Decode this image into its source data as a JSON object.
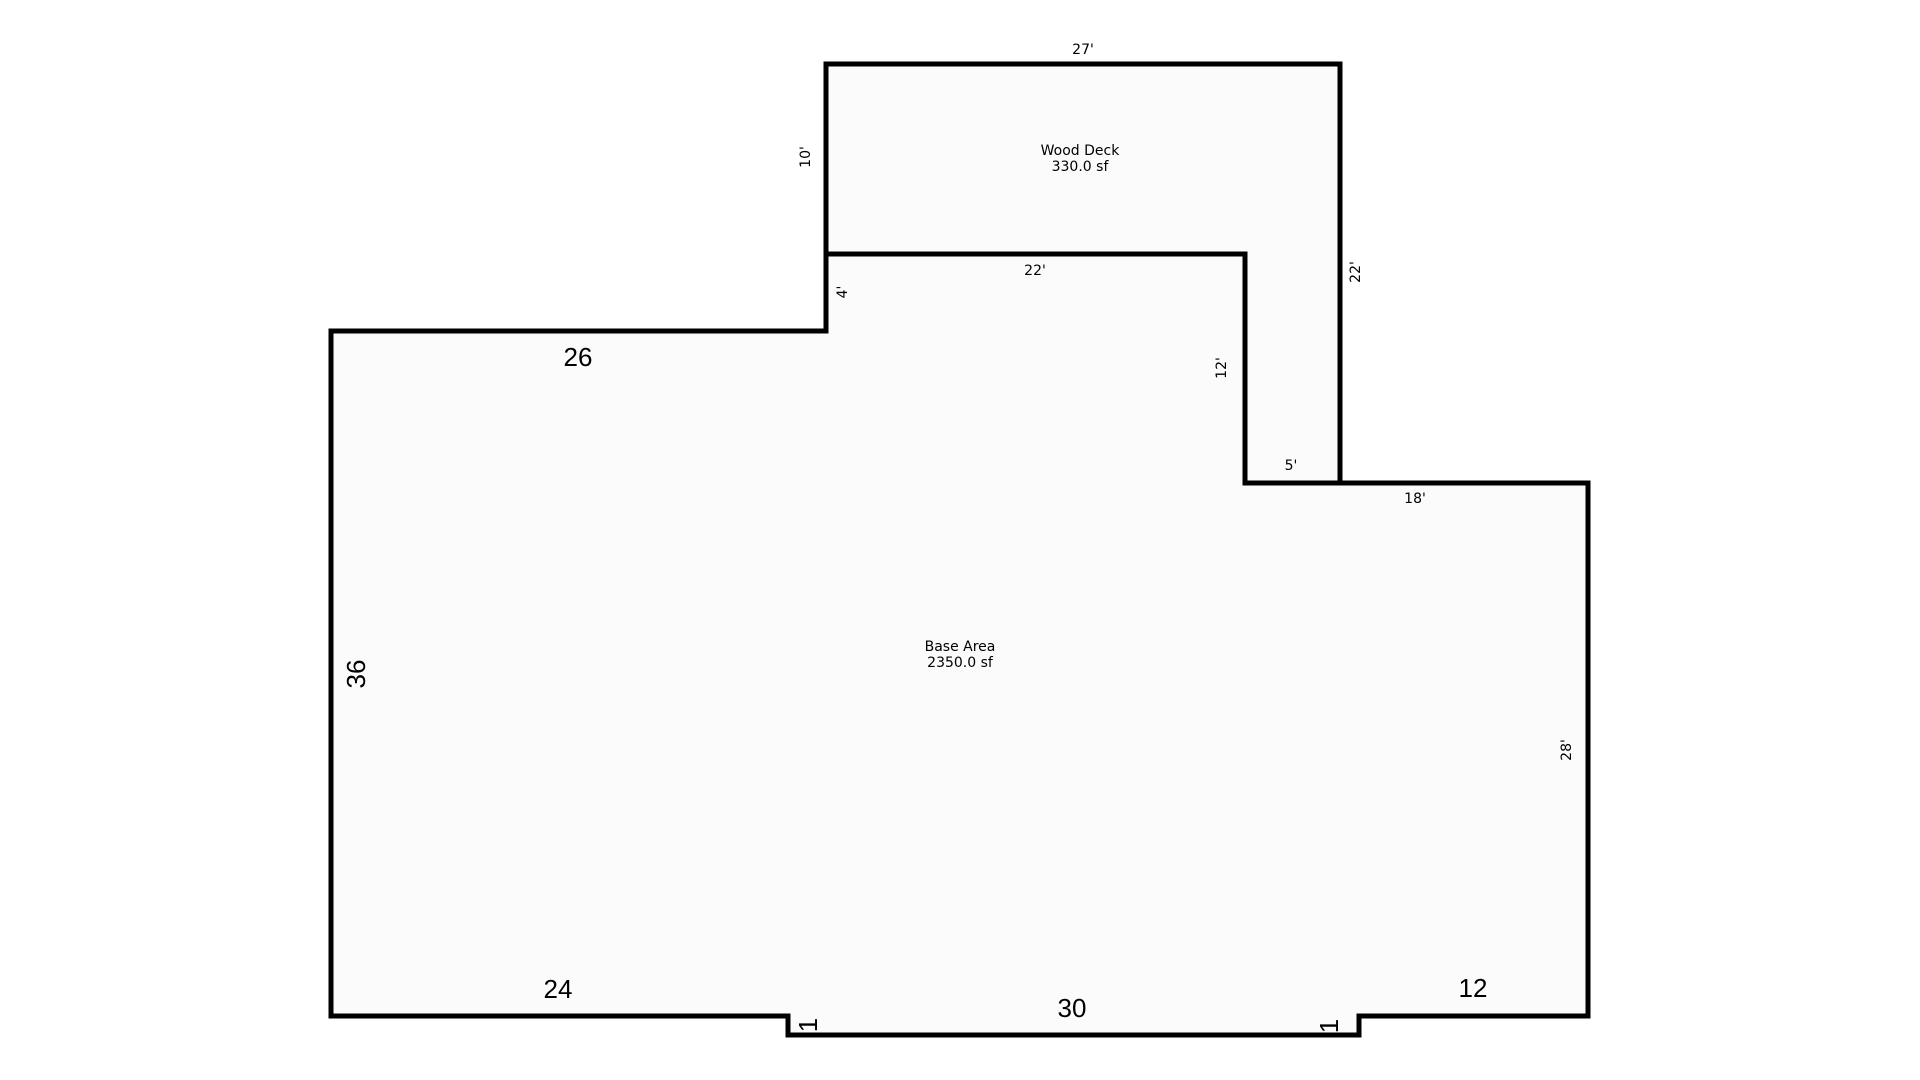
{
  "canvas": {
    "background_color": "#ffffff",
    "wall_color": "#000000",
    "interior_fill_color": "#fbfbfb"
  },
  "areas": {
    "wood_deck": {
      "name": "Wood Deck",
      "area": "330.0 sf"
    },
    "base": {
      "name": "Base Area",
      "area": "2350.0 sf"
    }
  },
  "dimensions": {
    "deck_top": "27'",
    "deck_left": "10'",
    "deck_right": "22'",
    "deck_bottom_shared": "22'",
    "deck_strip_height": "12'",
    "deck_strip_width": "5'",
    "base_step_left": "4'",
    "base_top": "26",
    "base_top_right": "18'",
    "base_left": "36",
    "base_right": "28'",
    "base_bottom_left": "24",
    "base_bottom_middle": "30",
    "base_bottom_right": "12",
    "notch_left": "1",
    "notch_right": "1"
  }
}
